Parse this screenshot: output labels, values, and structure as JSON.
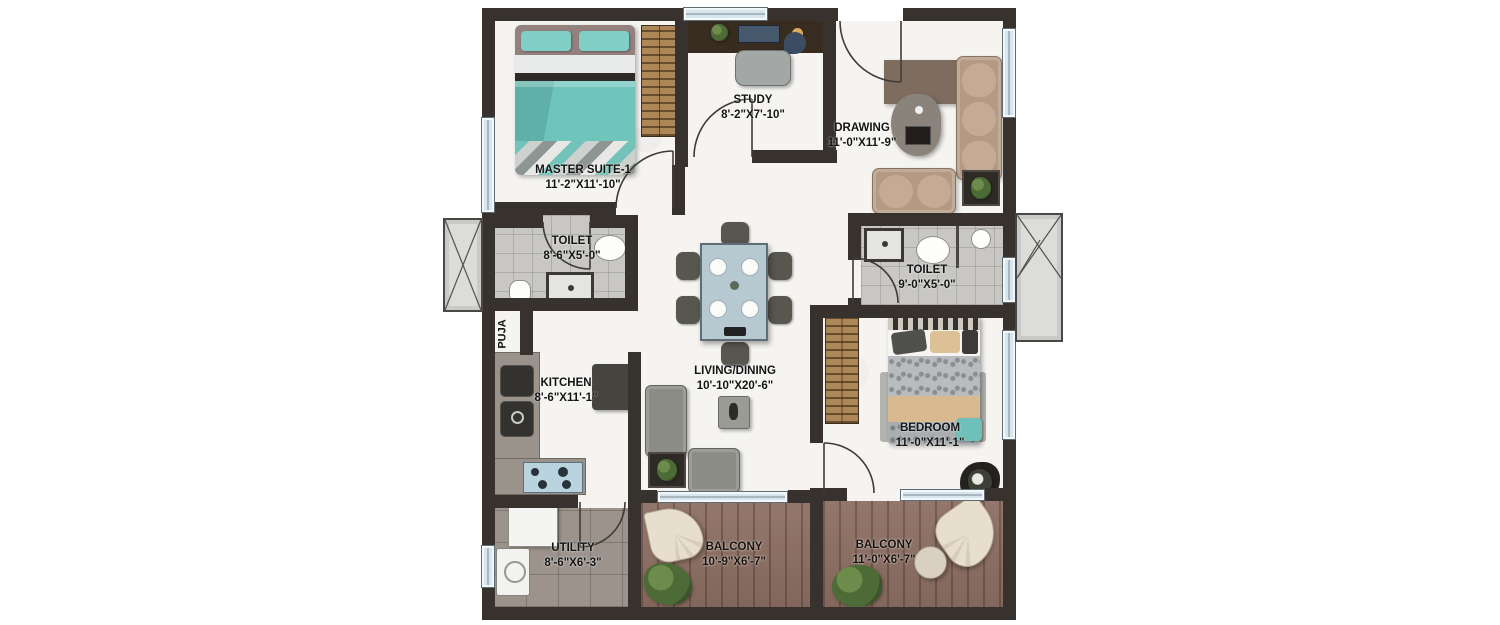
{
  "page": {
    "type": "apartment-floor-plan",
    "background": "#ffffff"
  },
  "palette": {
    "wall": "#37322d",
    "floor": "#f5f4f1",
    "tile_floor": "#c8c7c4",
    "balcony_floor": "#8d6f63",
    "utility_floor": "#9c948c",
    "window_glass": "#d6e5ee",
    "bed_teal": "#6fc4bc",
    "sofa_tan": "#b49a84",
    "sofa_gray": "#8c8c86",
    "wardrobe_wood": "#ad8757",
    "label_text": "#141414"
  },
  "rooms": [
    {
      "id": "master-suite-1",
      "name": "MASTER SUITE-1",
      "dims": "11'-2\"X11'-10\""
    },
    {
      "id": "study",
      "name": "STUDY",
      "dims": "8'-2\"X7'-10\""
    },
    {
      "id": "drawing",
      "name": "DRAWING",
      "dims": "11'-0\"X11'-9\""
    },
    {
      "id": "toilet-1",
      "name": "TOILET",
      "dims": "8'-6\"X5'-0\""
    },
    {
      "id": "puja",
      "name": "PUJA",
      "dims": ""
    },
    {
      "id": "kitchen",
      "name": "KITCHEN",
      "dims": "8'-6\"X11'-1\""
    },
    {
      "id": "living-dining",
      "name": "LIVING/DINING",
      "dims": "10'-10\"X20'-6\""
    },
    {
      "id": "toilet-2",
      "name": "TOILET",
      "dims": "9'-0\"X5'-0\""
    },
    {
      "id": "bedroom",
      "name": "BEDROOM",
      "dims": "11'-0\"X11'-1\""
    },
    {
      "id": "utility",
      "name": "UTILITY",
      "dims": "8'-6\"X6'-3\""
    },
    {
      "id": "balcony-1",
      "name": "BALCONY",
      "dims": "10'-9\"X6'-7\""
    },
    {
      "id": "balcony-2",
      "name": "BALCONY",
      "dims": "11'-0\"X6'-7\""
    }
  ]
}
